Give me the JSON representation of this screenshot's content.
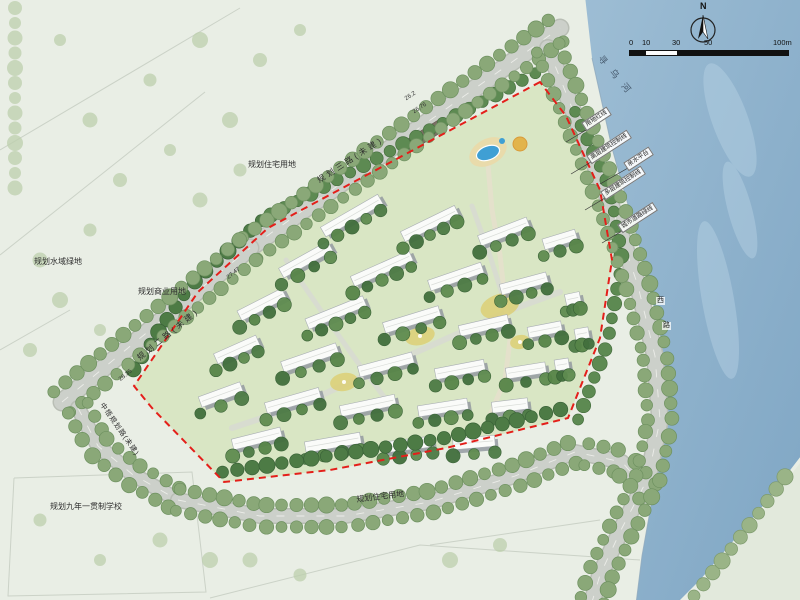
{
  "map": {
    "compass": {
      "north_label": "N"
    },
    "scale_bar": {
      "labels": [
        "0",
        "10",
        "30",
        "50",
        "100m"
      ]
    },
    "river": {
      "name": "寻乌河"
    },
    "roads": {
      "top_label": "规划三路(未建)",
      "left_label": "规划二路(未建)",
      "southwest_label": "中梧规划路(未建)",
      "riverside_char_1": "西",
      "riverside_char_2": "路"
    },
    "parcels": {
      "residential_nw": "规划住宅用地",
      "water_green": "规划水域绿地",
      "commercial": "规划商业用地",
      "school": "规划九年一贯制学校",
      "residential_south": "规划住宅用地"
    },
    "callouts": [
      "用地红线",
      "高层建筑控制线",
      "亲水平台",
      "多层建筑控制线",
      "城市道路绿线"
    ],
    "spot_elevations": [
      "26.2",
      "26.76",
      "27.47",
      "28.35"
    ],
    "colors": {
      "land": "#e9eee5",
      "river": "#9dbdd4",
      "river_deep": "#7fa6c4",
      "road": "#ccd0ca",
      "road_edge": "#b9beb5",
      "lawn": "#d9e6c4",
      "tree_street": "#8aa878",
      "tree_street_rim": "#6e9160",
      "tree_dark": "#4d7b45",
      "building": "#fafbf9",
      "building_shadow": "#8e959d",
      "boundary_red": "#e41f1a",
      "pool_blue": "#3f9fd4",
      "garden_yellow": "#dccf76"
    }
  }
}
